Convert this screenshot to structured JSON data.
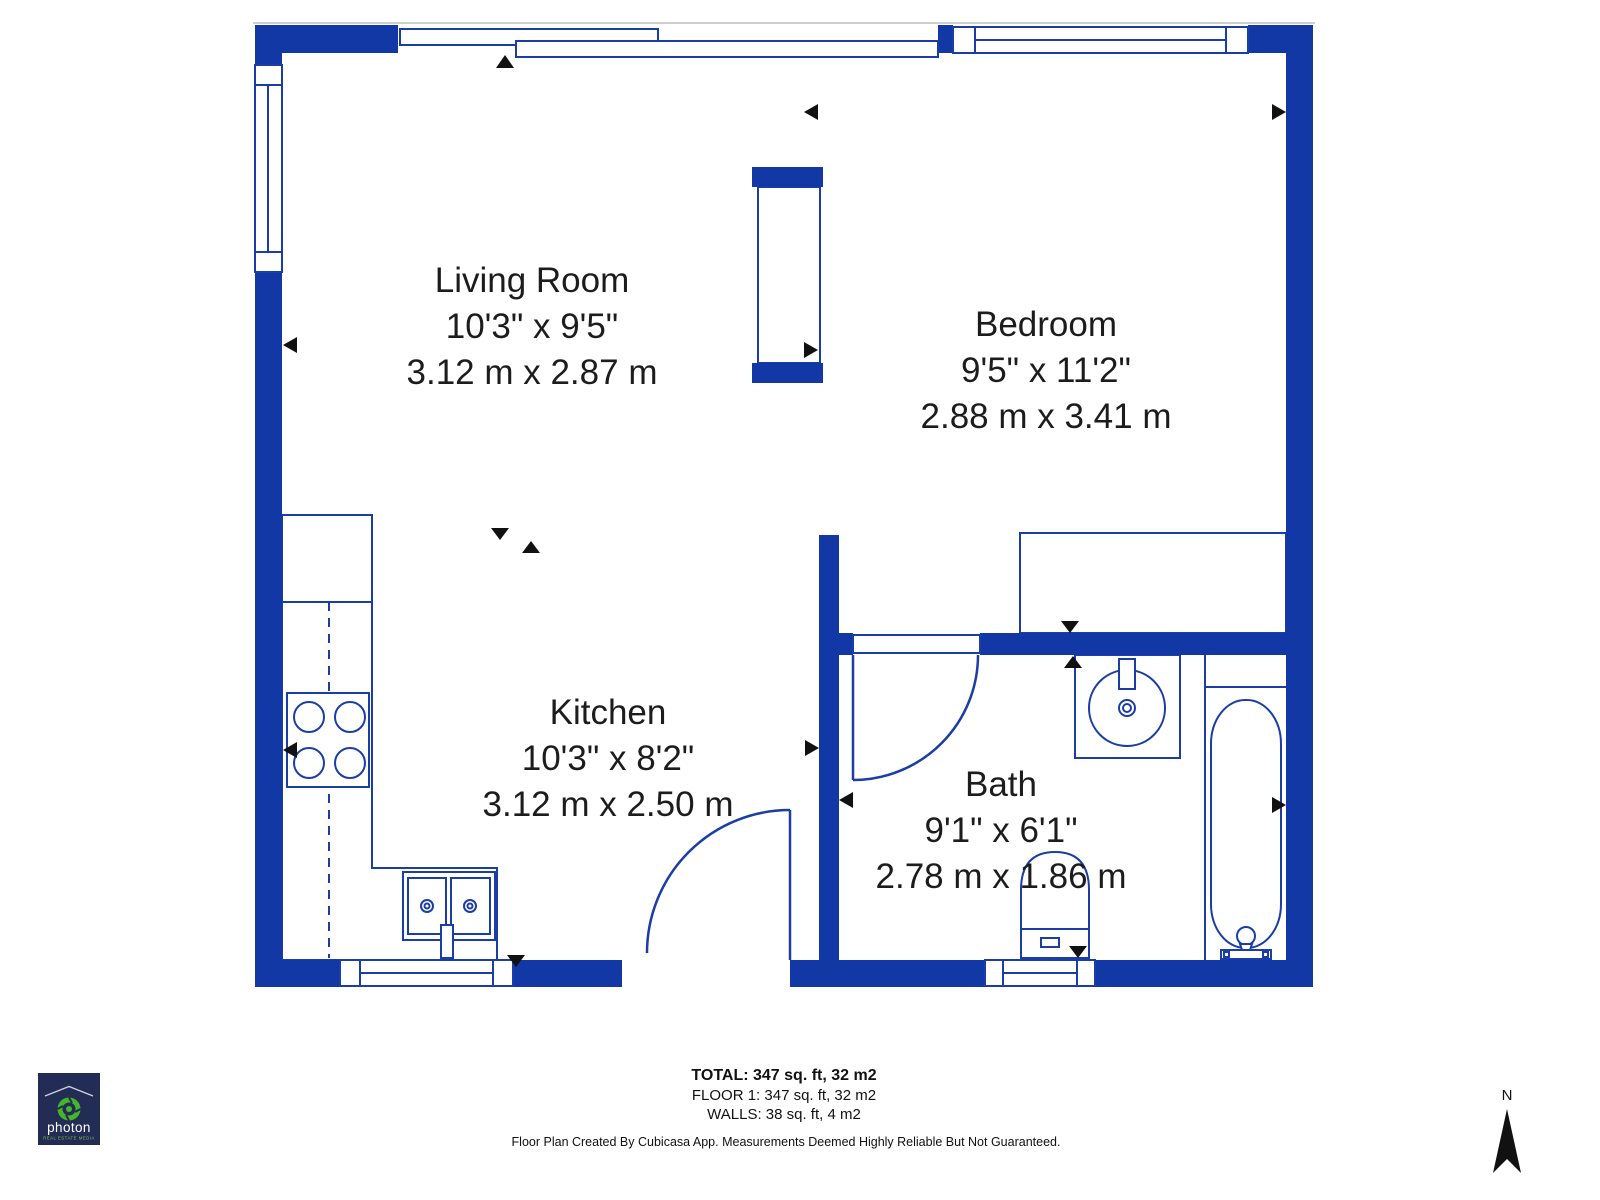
{
  "plan": {
    "rooms": [
      {
        "name": "Living Room",
        "imperial": "10'3\" x 9'5\"",
        "metric": "3.12 m x 2.87 m"
      },
      {
        "name": "Bedroom",
        "imperial": "9'5\" x 11'2\"",
        "metric": "2.88 m x 3.41 m"
      },
      {
        "name": "Kitchen",
        "imperial": "10'3\" x 8'2\"",
        "metric": "3.12 m x 2.50 m"
      },
      {
        "name": "Bath",
        "imperial": "9'1\" x 6'1\"",
        "metric": "2.78 m x 1.86 m"
      }
    ],
    "colors": {
      "wall_blue": "#1138a5",
      "fixture_line_blue": "#1b3da6",
      "marker_black": "#111111",
      "label_text": "#1c1c1c"
    }
  },
  "footer": {
    "total": "TOTAL: 347 sq. ft, 32 m2",
    "floor": "FLOOR 1: 347 sq. ft, 32 m2",
    "walls": "WALLS: 38 sq. ft, 4 m2",
    "disclaimer": "Floor Plan Created By Cubicasa App. Measurements Deemed Highly Reliable But Not Guaranteed."
  },
  "logo": {
    "wordmark": "photon",
    "tagline": "REAL ESTATE MEDIA",
    "bg": "#232c54",
    "accent_green": "#45b52a"
  },
  "compass": {
    "north_label": "N"
  }
}
